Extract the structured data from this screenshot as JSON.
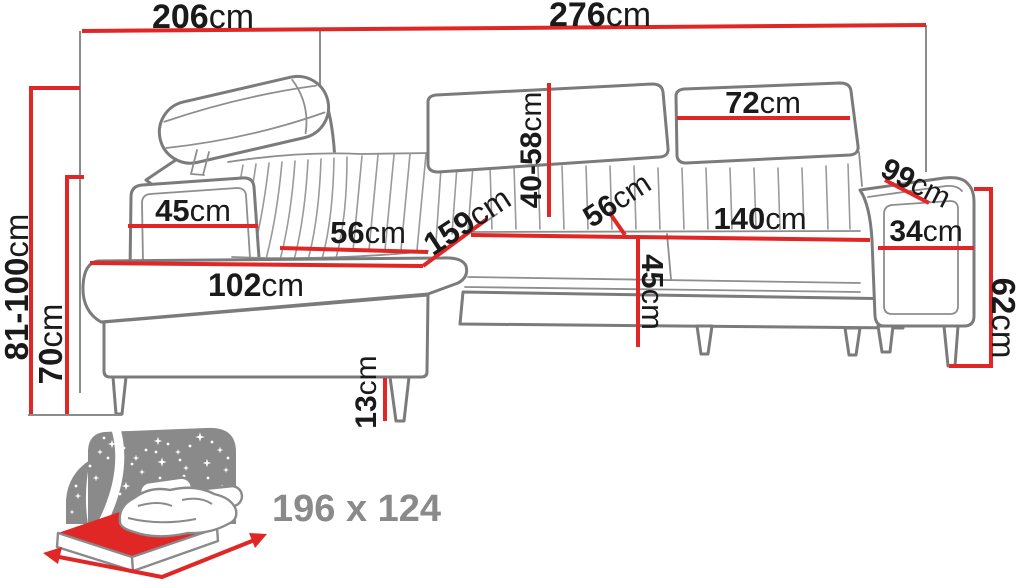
{
  "diagram": {
    "title": "corner-sofa-dimension-diagram",
    "colors": {
      "dimension_red": "#e12626",
      "outline_gray": "#7b7b7b",
      "pleat_gray": "#9a9a9a",
      "reference_gray": "#8c8c8c",
      "icon_gray": "#8a8a8a",
      "label_black": "#1a1a1a"
    },
    "dims": [
      {
        "id": "overall-width-left",
        "value": "206",
        "unit": "cm"
      },
      {
        "id": "overall-width-right",
        "value": "276",
        "unit": "cm"
      },
      {
        "id": "backrest-height-range",
        "value": "81-100",
        "unit": "cm"
      },
      {
        "id": "armrest-height-left",
        "value": "70",
        "unit": "cm"
      },
      {
        "id": "left-armrest-top-depth",
        "value": "45",
        "unit": "cm"
      },
      {
        "id": "chaise-seat-width",
        "value": "56",
        "unit": "cm"
      },
      {
        "id": "chaise-front-length",
        "value": "102",
        "unit": "cm"
      },
      {
        "id": "chaise-diagonal-depth",
        "value": "159",
        "unit": "cm"
      },
      {
        "id": "backrest-cushion-height",
        "value": "40-58",
        "unit": "cm"
      },
      {
        "id": "seat-depth-middle",
        "value": "56",
        "unit": "cm"
      },
      {
        "id": "seat-width-middle",
        "value": "140",
        "unit": "cm"
      },
      {
        "id": "seat-height-middle",
        "value": "45",
        "unit": "cm"
      },
      {
        "id": "backrest-cushion-width",
        "value": "72",
        "unit": "cm"
      },
      {
        "id": "right-armrest-top-diagonal",
        "value": "99",
        "unit": "cm"
      },
      {
        "id": "right-armrest-width",
        "value": "34",
        "unit": "cm"
      },
      {
        "id": "right-armrest-height",
        "value": "62",
        "unit": "cm"
      },
      {
        "id": "leg-height",
        "value": "13",
        "unit": "cm"
      }
    ],
    "sleeping": {
      "icon": "sleeping-function-bed-icon",
      "value": "196 x 124"
    }
  }
}
